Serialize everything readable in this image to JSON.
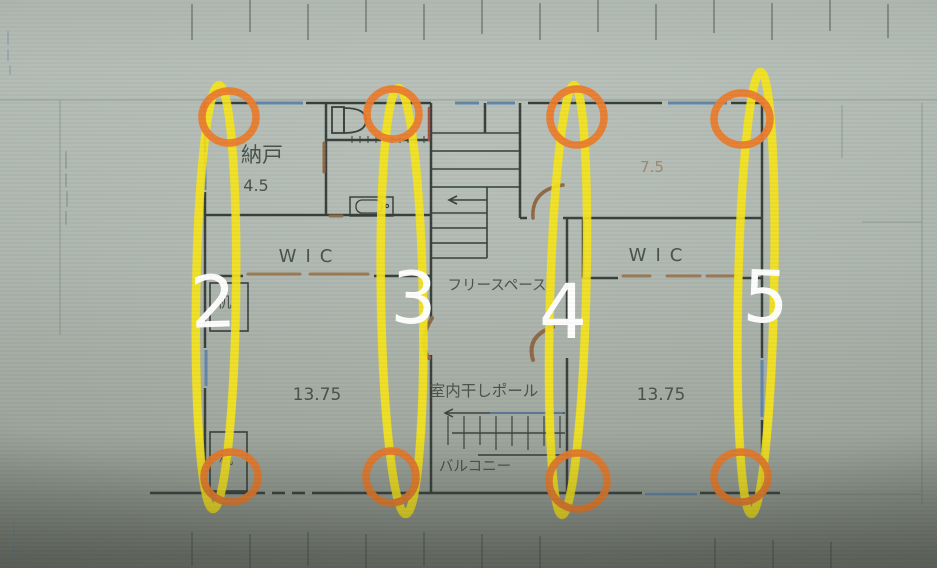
{
  "plan": {
    "labels": {
      "nando": "納戸",
      "nando_size": "4.5",
      "wic_left": "WIC",
      "wic_right": "WIC",
      "free_space": "フリースペース",
      "indoor_drying_pole": "室内干しポール",
      "balcony": "バルコニー",
      "desk_upper": "机",
      "desk_lower": "机",
      "bedroom_left_size": "13.75",
      "bedroom_right_size": "13.75",
      "top_right_room_size": "7.5"
    }
  },
  "annotations": {
    "column_numbers": [
      "2",
      "3",
      "4",
      "5"
    ],
    "colors": {
      "highlight_yellow": "#f6e41c",
      "circle_orange": "#e97c2d",
      "number_white": "#ffffff",
      "wall_dark": "#39413c",
      "window_blue": "#5b81aa",
      "door_brown": "#8f6a47"
    }
  }
}
